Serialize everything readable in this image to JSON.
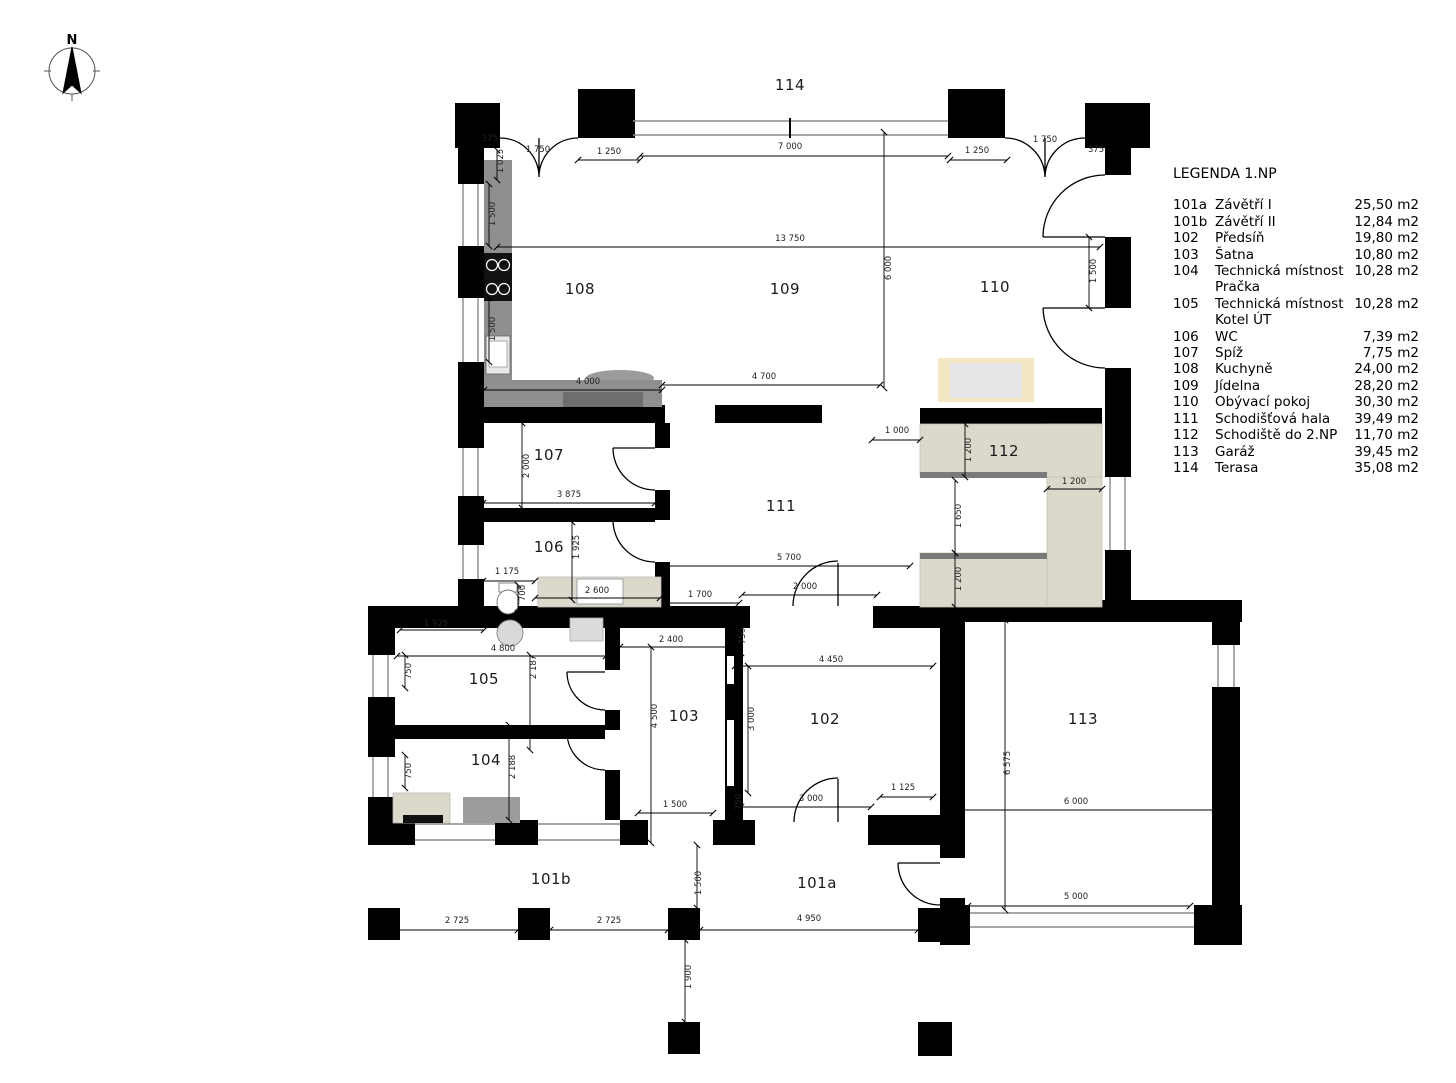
{
  "north": {
    "label": "N"
  },
  "legend": {
    "title": "LEGENDA 1.NP",
    "items": [
      {
        "code": "101a",
        "name": "Závětří I",
        "area": "25,50 m2"
      },
      {
        "code": "101b",
        "name": "Závětří II",
        "area": "12,84 m2"
      },
      {
        "code": "102",
        "name": "Předsíň",
        "area": "19,80 m2"
      },
      {
        "code": "103",
        "name": "Šatna",
        "area": "10,80 m2"
      },
      {
        "code": "104",
        "name": "Technická místnost",
        "name2": "Pračka",
        "area": "10,28 m2"
      },
      {
        "code": "105",
        "name": "Technická místnost",
        "name2": "Kotel ÚT",
        "area": "10,28 m2"
      },
      {
        "code": "106",
        "name": "WC",
        "area": "7,39 m2"
      },
      {
        "code": "107",
        "name": "Spíž",
        "area": "7,75 m2"
      },
      {
        "code": "108",
        "name": "Kuchyně",
        "area": "24,00 m2"
      },
      {
        "code": "109",
        "name": "Jídelna",
        "area": "28,20 m2"
      },
      {
        "code": "110",
        "name": "Obývací pokoj",
        "area": "30,30 m2"
      },
      {
        "code": "111",
        "name": "Schodišťová hala",
        "area": "39,49 m2"
      },
      {
        "code": "112",
        "name": "Schodiště do 2.NP",
        "area": "11,70 m2"
      },
      {
        "code": "113",
        "name": "Garáž",
        "area": "39,45 m2"
      },
      {
        "code": "114",
        "name": "Terasa",
        "area": "35,08 m2"
      }
    ]
  },
  "rooms": [
    {
      "id": "114",
      "x": 790,
      "y": 85
    },
    {
      "id": "108",
      "x": 580,
      "y": 289
    },
    {
      "id": "109",
      "x": 785,
      "y": 289
    },
    {
      "id": "110",
      "x": 995,
      "y": 287
    },
    {
      "id": "107",
      "x": 549,
      "y": 455
    },
    {
      "id": "111",
      "x": 781,
      "y": 506
    },
    {
      "id": "112",
      "x": 1004,
      "y": 451
    },
    {
      "id": "106",
      "x": 549,
      "y": 547
    },
    {
      "id": "105",
      "x": 484,
      "y": 679
    },
    {
      "id": "104",
      "x": 486,
      "y": 760
    },
    {
      "id": "103",
      "x": 684,
      "y": 716
    },
    {
      "id": "102",
      "x": 825,
      "y": 719
    },
    {
      "id": "113",
      "x": 1083,
      "y": 719
    },
    {
      "id": "101b",
      "x": 551,
      "y": 879
    },
    {
      "id": "101a",
      "x": 817,
      "y": 883
    }
  ],
  "dims": [
    {
      "t": "375",
      "x": 490,
      "y": 139
    },
    {
      "t": "1 750",
      "x": 538,
      "y": 150
    },
    {
      "t": "1 250",
      "x": 609,
      "y": 152
    },
    {
      "t": "7 000",
      "x": 790,
      "y": 147
    },
    {
      "t": "1 250",
      "x": 977,
      "y": 151
    },
    {
      "t": "1 750",
      "x": 1045,
      "y": 140
    },
    {
      "t": "375",
      "x": 1096,
      "y": 150
    },
    {
      "t": "1 025",
      "x": 501,
      "y": 161,
      "v": 1
    },
    {
      "t": "1 500",
      "x": 493,
      "y": 214,
      "v": 1
    },
    {
      "t": "13 750",
      "x": 790,
      "y": 239
    },
    {
      "t": "6 000",
      "x": 889,
      "y": 268,
      "v": 1
    },
    {
      "t": "1 500",
      "x": 1094,
      "y": 271,
      "v": 1
    },
    {
      "t": "1 500",
      "x": 493,
      "y": 329,
      "v": 1
    },
    {
      "t": "4 000",
      "x": 588,
      "y": 382
    },
    {
      "t": "4 700",
      "x": 764,
      "y": 377
    },
    {
      "t": "1 000",
      "x": 897,
      "y": 431
    },
    {
      "t": "2 000",
      "x": 527,
      "y": 466,
      "v": 1
    },
    {
      "t": "3 875",
      "x": 569,
      "y": 495
    },
    {
      "t": "1 925",
      "x": 577,
      "y": 547,
      "v": 1
    },
    {
      "t": "1 175",
      "x": 507,
      "y": 572
    },
    {
      "t": "700",
      "x": 523,
      "y": 593,
      "v": 1
    },
    {
      "t": "2 600",
      "x": 597,
      "y": 591
    },
    {
      "t": "1 700",
      "x": 700,
      "y": 595
    },
    {
      "t": "5 700",
      "x": 789,
      "y": 558
    },
    {
      "t": "2 000",
      "x": 805,
      "y": 587
    },
    {
      "t": "1 200",
      "x": 969,
      "y": 450,
      "v": 1
    },
    {
      "t": "1 200",
      "x": 1074,
      "y": 482
    },
    {
      "t": "1 650",
      "x": 959,
      "y": 516,
      "v": 1
    },
    {
      "t": "1 200",
      "x": 959,
      "y": 579,
      "v": 1
    },
    {
      "t": "1 925",
      "x": 436,
      "y": 624
    },
    {
      "t": "4 800",
      "x": 503,
      "y": 649
    },
    {
      "t": "750",
      "x": 409,
      "y": 671,
      "v": 1
    },
    {
      "t": "2 187",
      "x": 534,
      "y": 667,
      "v": 1
    },
    {
      "t": "2 400",
      "x": 671,
      "y": 640
    },
    {
      "t": "750",
      "x": 743,
      "y": 636,
      "v": 1
    },
    {
      "t": "4 450",
      "x": 831,
      "y": 660
    },
    {
      "t": "4 500",
      "x": 655,
      "y": 716,
      "v": 1
    },
    {
      "t": "3 000",
      "x": 752,
      "y": 719,
      "v": 1
    },
    {
      "t": "2 188",
      "x": 513,
      "y": 767,
      "v": 1
    },
    {
      "t": "750",
      "x": 409,
      "y": 771,
      "v": 1
    },
    {
      "t": "1 500",
      "x": 675,
      "y": 805
    },
    {
      "t": "750",
      "x": 739,
      "y": 802,
      "v": 1
    },
    {
      "t": "3 000",
      "x": 811,
      "y": 799
    },
    {
      "t": "1 125",
      "x": 903,
      "y": 788
    },
    {
      "t": "6 575",
      "x": 1008,
      "y": 763,
      "v": 1
    },
    {
      "t": "6 000",
      "x": 1076,
      "y": 802
    },
    {
      "t": "5 000",
      "x": 1076,
      "y": 897
    },
    {
      "t": "2 725",
      "x": 457,
      "y": 921
    },
    {
      "t": "2 725",
      "x": 609,
      "y": 921
    },
    {
      "t": "1 500",
      "x": 699,
      "y": 883,
      "v": 1
    },
    {
      "t": "4 950",
      "x": 809,
      "y": 919
    },
    {
      "t": "1 900",
      "x": 689,
      "y": 977,
      "v": 1
    }
  ],
  "colors": {
    "wall": "#000000",
    "marble": "#ddd8cc",
    "nosing": "#7a7a7a",
    "kitchen": "#8f8f8f",
    "kitchen_dark": "#6e6e6e",
    "sofa": "#f4e7c3",
    "sofa_inner": "#e7e7e9",
    "glazing": "#8a8a8a"
  }
}
